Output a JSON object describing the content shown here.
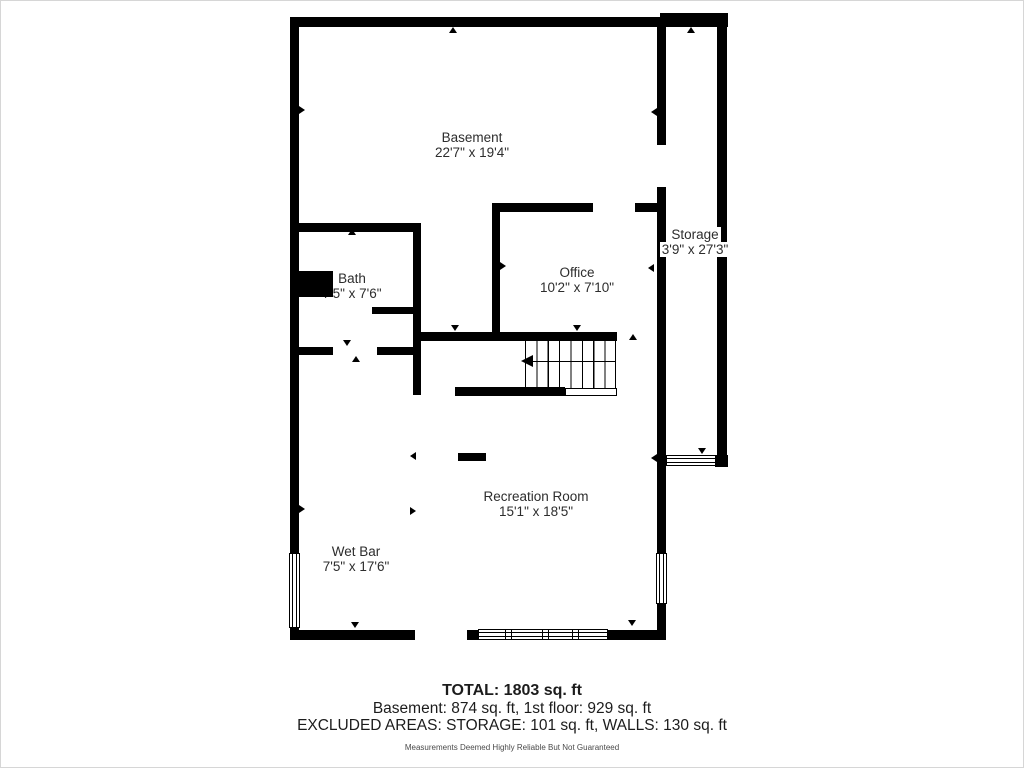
{
  "rooms": {
    "basement": {
      "name": "Basement",
      "dims": "22'7\" x 19'4\""
    },
    "storage": {
      "name": "Storage",
      "dims": "3'9\" x 27'3\""
    },
    "bath": {
      "name": "Bath",
      "dims": "7'5\" x 7'6\""
    },
    "office": {
      "name": "Office",
      "dims": "10'2\" x 7'10\""
    },
    "recreation": {
      "name": "Recreation Room",
      "dims": "15'1\" x 18'5\""
    },
    "wetbar": {
      "name": "Wet Bar",
      "dims": "7'5\" x 17'6\""
    }
  },
  "summary": {
    "total": "TOTAL: 1803 sq. ft",
    "floors": "Basement: 874 sq. ft, 1st floor: 929 sq. ft",
    "excluded": "EXCLUDED AREAS: STORAGE: 101 sq. ft, WALLS: 130 sq. ft",
    "disclaimer": "Measurements Deemed Highly Reliable But Not Guaranteed"
  },
  "colors": {
    "wall": "#000000",
    "text": "#2d2d2d",
    "background": "#ffffff"
  }
}
